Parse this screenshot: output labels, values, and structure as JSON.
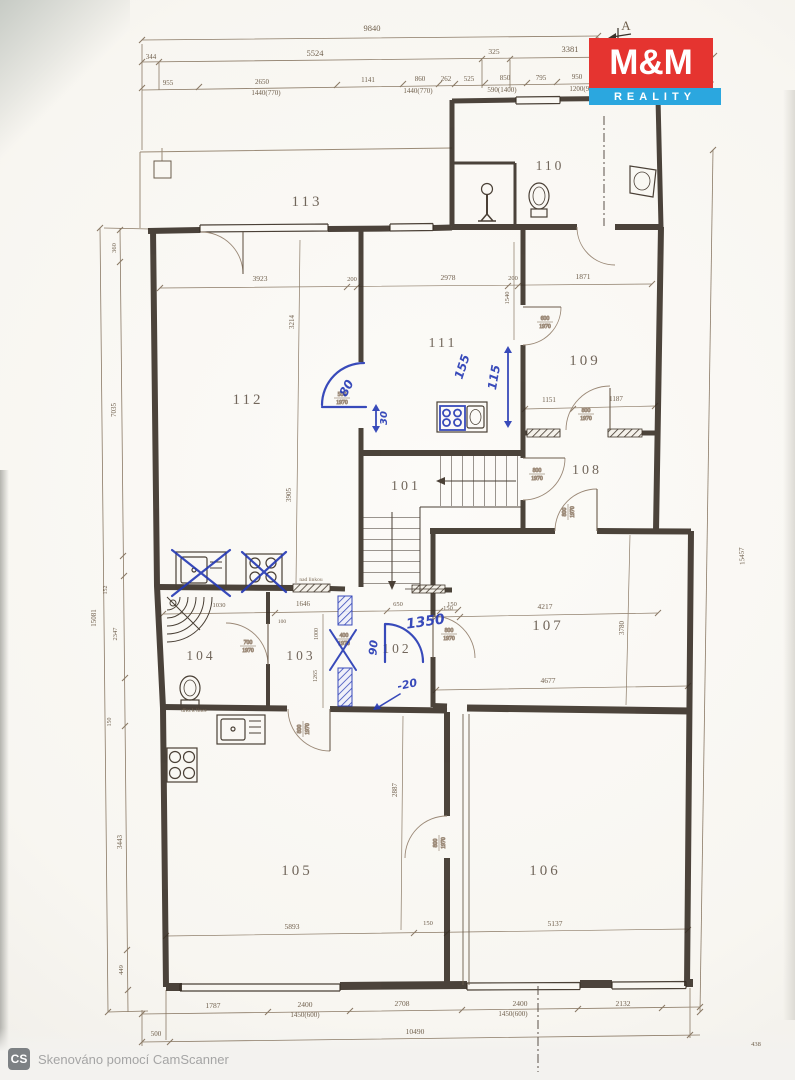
{
  "marker_a": "A",
  "logo": {
    "mm": "M&M",
    "reality": "REALITY"
  },
  "watermark": {
    "badge": "CS",
    "text": "Skenováno pomocí CamScanner"
  },
  "rooms": {
    "r101": "101",
    "r102": "102",
    "r103": "103",
    "r104": "104",
    "r105": "105",
    "r106": "106",
    "r107": "107",
    "r108": "108",
    "r109": "109",
    "r110": "110",
    "r111": "111",
    "r112": "112",
    "r113": "113"
  },
  "dims": {
    "top_total": "9840",
    "t344": "344",
    "t5524": "5524",
    "t325": "325",
    "t3381": "3381",
    "t955": "955",
    "t2650": "2650",
    "t1141": "1141",
    "t860": "860",
    "t262": "262",
    "t525": "525",
    "t850": "850",
    "t795": "795",
    "t950": "950",
    "win_w1": "1440(770)",
    "win_w2": "590(1400)",
    "win_w3": "1200(900)",
    "left_total": "15081",
    "l360": "360",
    "l7035": "7035",
    "l152": "152",
    "l2347": "2347",
    "l3443": "3443",
    "l449": "449",
    "right_total": "15457",
    "b1787": "1787",
    "b2400": "2400",
    "b2708": "2708",
    "b2132": "2132",
    "b_win": "1450(600)",
    "b500": "500",
    "b10490": "10490",
    "b438": "438",
    "n150": "150",
    "n200": "200",
    "i3923": "3923",
    "i2978": "2978",
    "i1871": "1871",
    "i3214": "3214",
    "i3905": "3905",
    "i1540": "1540",
    "i1151": "1151",
    "i1187": "1187",
    "i4217": "4217",
    "i3780": "3780",
    "i4677": "4677",
    "i1030": "1030",
    "i1646": "1646",
    "i100": "100",
    "i1000": "1000",
    "i650": "650",
    "i1265": "1265",
    "i5893": "5893",
    "i5137": "5137",
    "i2887": "2887"
  },
  "doors": {
    "w800": "800",
    "w700": "700",
    "w600": "600",
    "w500": "500",
    "w400": "400",
    "h": "1970"
  },
  "pen": {
    "a80": "80",
    "a30": "30",
    "a155": "155",
    "a115": "115",
    "a1350": "1350",
    "a90": "90",
    "a20": "-20"
  },
  "notes": {
    "nad_linkou": "nad linkou",
    "drez": "dřez k lince"
  }
}
